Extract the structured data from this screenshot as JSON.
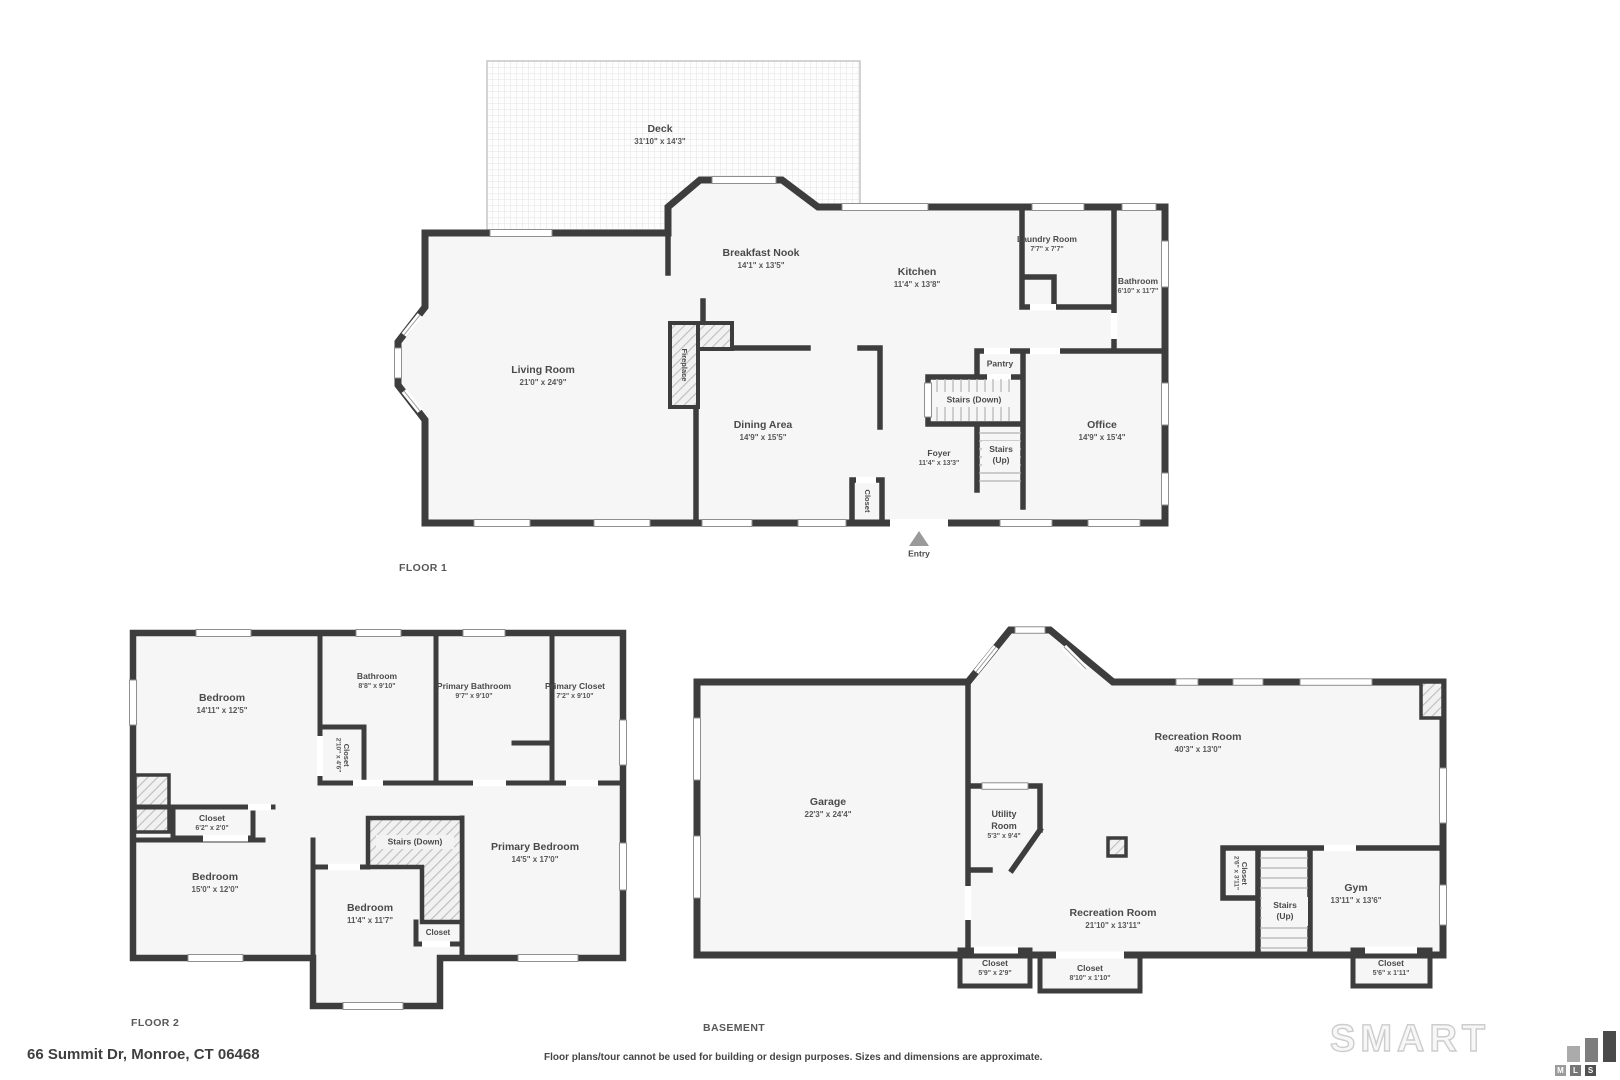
{
  "colors": {
    "wall": "#3d3d3d",
    "room_fill": "#f6f6f6",
    "label_text": "#4a4a4a"
  },
  "floor1": {
    "caption": "FLOOR 1",
    "deck": {
      "name": "Deck",
      "dims": "31'10\" x 14'3\""
    },
    "breakfast_nook": {
      "name": "Breakfast Nook",
      "dims": "14'1\" x 13'5\""
    },
    "kitchen": {
      "name": "Kitchen",
      "dims": "11'4\" x 13'8\""
    },
    "laundry_room": {
      "name": "Laundry Room",
      "dims": "7'7\" x 7'7\""
    },
    "bathroom": {
      "name": "Bathroom",
      "dims": "6'10\" x 11'7\""
    },
    "living_room": {
      "name": "Living Room",
      "dims": "21'0\" x 24'9\""
    },
    "dining_area": {
      "name": "Dining Area",
      "dims": "14'9\" x 15'5\""
    },
    "office": {
      "name": "Office",
      "dims": "14'9\" x 15'4\""
    },
    "foyer": {
      "name": "Foyer",
      "dims": "11'4\" x 13'3\""
    },
    "pantry": {
      "name": "Pantry"
    },
    "stairs_down": {
      "name": "Stairs (Down)"
    },
    "stairs_up": {
      "line1": "Stairs",
      "line2": "(Up)"
    },
    "fireplace": {
      "name": "Fireplace"
    },
    "closet": {
      "name": "Closet"
    },
    "entry": {
      "name": "Entry"
    }
  },
  "floor2": {
    "caption": "FLOOR 2",
    "bedroom_a": {
      "name": "Bedroom",
      "dims": "14'11\" x 12'5\""
    },
    "bathroom": {
      "name": "Bathroom",
      "dims": "8'8\" x 9'10\""
    },
    "closet_hall": {
      "name": "Closet",
      "dims": "2'10\" x 4'6\""
    },
    "primary_bathroom": {
      "name": "Primary Bathroom",
      "dims": "9'7\" x 9'10\""
    },
    "primary_closet": {
      "name": "Primary Closet",
      "dims": "7'2\" x 9'10\""
    },
    "closet_b": {
      "name": "Closet",
      "dims": "6'2\" x 2'0\""
    },
    "stairs_down": {
      "name": "Stairs (Down)"
    },
    "bedroom_b": {
      "name": "Bedroom",
      "dims": "15'0\" x 12'0\""
    },
    "bedroom_c": {
      "name": "Bedroom",
      "dims": "11'4\" x 11'7\""
    },
    "closet_c": {
      "name": "Closet"
    },
    "primary_bedroom": {
      "name": "Primary Bedroom",
      "dims": "14'5\" x 17'0\""
    }
  },
  "basement": {
    "caption": "BASEMENT",
    "garage": {
      "name": "Garage",
      "dims": "22'3\" x 24'4\""
    },
    "utility_room": {
      "line1": "Utility",
      "line2": "Room",
      "dims": "5'3\" x 9'4\""
    },
    "recreation_room_a": {
      "name": "Recreation Room",
      "dims": "40'3\" x 13'0\""
    },
    "closet_stairs": {
      "name": "Closet",
      "dims": "2'6\" x 3'11\""
    },
    "stairs_up": {
      "line1": "Stairs",
      "line2": "(Up)"
    },
    "recreation_room_b": {
      "name": "Recreation Room",
      "dims": "21'10\" x 13'11\""
    },
    "gym": {
      "name": "Gym",
      "dims": "13'11\" x 13'6\""
    },
    "closet_a": {
      "name": "Closet",
      "dims": "5'9\" x 2'9\""
    },
    "closet_b": {
      "name": "Closet",
      "dims": "8'10\" x 1'10\""
    },
    "closet_c": {
      "name": "Closet",
      "dims": "5'6\" x 1'11\""
    }
  },
  "footer": {
    "address": "66 Summit Dr, Monroe, CT 06468",
    "disclaimer": "Floor plans/tour cannot be used for building or design purposes. Sizes and dimensions are approximate.",
    "brand": {
      "word": "SMART",
      "letters": [
        "M",
        "L",
        "S"
      ]
    }
  }
}
